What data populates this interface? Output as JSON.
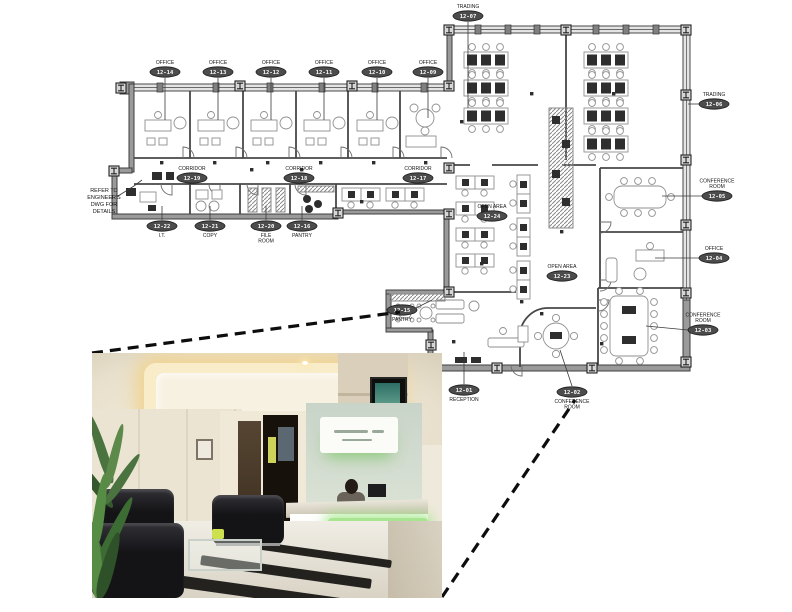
{
  "meta": {
    "title": "Office floor plan with reception lobby photo callout"
  },
  "plan": {
    "note_lines": [
      "REFER TO",
      "ENGINEER'S",
      "DWG FOR",
      "DETAILS"
    ],
    "labels": [
      {
        "id": "office-12-14",
        "name_lines": [
          "OFFICE"
        ],
        "number": "12-14",
        "x": 165,
        "y": 72,
        "name_pos": "above",
        "leader": [
          165,
          78,
          165,
          120
        ]
      },
      {
        "id": "office-12-13",
        "name_lines": [
          "OFFICE"
        ],
        "number": "12-13",
        "x": 218,
        "y": 72,
        "name_pos": "above",
        "leader": [
          218,
          78,
          218,
          120
        ]
      },
      {
        "id": "office-12-12",
        "name_lines": [
          "OFFICE"
        ],
        "number": "12-12",
        "x": 271,
        "y": 72,
        "name_pos": "above",
        "leader": [
          271,
          78,
          271,
          120
        ]
      },
      {
        "id": "office-12-11",
        "name_lines": [
          "OFFICE"
        ],
        "number": "12-11",
        "x": 324,
        "y": 72,
        "name_pos": "above",
        "leader": [
          324,
          78,
          324,
          120
        ]
      },
      {
        "id": "office-12-10",
        "name_lines": [
          "OFFICE"
        ],
        "number": "12-10",
        "x": 377,
        "y": 72,
        "name_pos": "above",
        "leader": [
          377,
          78,
          377,
          120
        ]
      },
      {
        "id": "office-12-09",
        "name_lines": [
          "OFFICE"
        ],
        "number": "12-09",
        "x": 428,
        "y": 72,
        "name_pos": "above",
        "leader": [
          428,
          78,
          428,
          118
        ]
      },
      {
        "id": "trading-12-07",
        "name_lines": [
          "TRADING"
        ],
        "number": "12-07",
        "x": 468,
        "y": 16,
        "name_pos": "above",
        "leader": [
          468,
          22,
          468,
          108
        ]
      },
      {
        "id": "trading-12-06",
        "name_lines": [
          "TRADING"
        ],
        "number": "12-06",
        "x": 714,
        "y": 104,
        "name_pos": "above",
        "leader": [
          699,
          104,
          688,
          104
        ]
      },
      {
        "id": "conference-room-12-05",
        "name_lines": [
          "CONFERENCE",
          "ROOM"
        ],
        "number": "12-05",
        "x": 717,
        "y": 196,
        "name_pos": "above",
        "leader": [
          702,
          196,
          662,
          196
        ]
      },
      {
        "id": "office-12-04",
        "name_lines": [
          "OFFICE"
        ],
        "number": "12-04",
        "x": 714,
        "y": 258,
        "name_pos": "above",
        "leader": [
          699,
          258,
          655,
          258
        ]
      },
      {
        "id": "conference-room-12-03",
        "name_lines": [
          "CONFERENCE",
          "ROOM"
        ],
        "number": "12-03",
        "x": 703,
        "y": 330,
        "name_pos": "above",
        "leader": [
          688,
          330,
          646,
          326
        ]
      },
      {
        "id": "conference-room-12-02",
        "name_lines": [
          "CONFERENCE",
          "ROOM"
        ],
        "number": "12-02",
        "x": 572,
        "y": 392,
        "name_pos": "below",
        "leader": [
          572,
          386,
          560,
          350
        ]
      },
      {
        "id": "reception-12-01",
        "name_lines": [
          "RECEPTION"
        ],
        "number": "12-01",
        "x": 464,
        "y": 390,
        "name_pos": "below",
        "leader": [
          464,
          384,
          464,
          352
        ]
      },
      {
        "id": "pantry-12-15",
        "name_lines": [
          "PANTRY"
        ],
        "number": "12-15",
        "x": 402,
        "y": 310,
        "name_pos": "below",
        "leader": [
          416,
          308,
          432,
          300
        ]
      },
      {
        "id": "open-area-12-24",
        "name_lines": [
          "OPEN AREA"
        ],
        "number": "12-24",
        "x": 492,
        "y": 216,
        "name_pos": "above"
      },
      {
        "id": "open-area-12-23",
        "name_lines": [
          "OPEN AREA"
        ],
        "number": "12-23",
        "x": 562,
        "y": 276,
        "name_pos": "above"
      },
      {
        "id": "corridor-12-19",
        "name_lines": [
          "CORRIDOR"
        ],
        "number": "12-19",
        "x": 192,
        "y": 178,
        "name_pos": "above"
      },
      {
        "id": "corridor-12-18",
        "name_lines": [
          "CORRIDOR"
        ],
        "number": "12-18",
        "x": 299,
        "y": 178,
        "name_pos": "above"
      },
      {
        "id": "corridor-12-17",
        "name_lines": [
          "CORRIDOR"
        ],
        "number": "12-17",
        "x": 418,
        "y": 178,
        "name_pos": "above"
      },
      {
        "id": "it-12-22",
        "name_lines": [
          "I.T."
        ],
        "number": "12-22",
        "x": 162,
        "y": 226,
        "name_pos": "below",
        "leader": [
          162,
          220,
          162,
          206
        ]
      },
      {
        "id": "copy-12-21",
        "name_lines": [
          "COPY"
        ],
        "number": "12-21",
        "x": 210,
        "y": 226,
        "name_pos": "below",
        "leader": [
          210,
          220,
          210,
          206
        ]
      },
      {
        "id": "file-room-12-20",
        "name_lines": [
          "FILE",
          "ROOM"
        ],
        "number": "12-20",
        "x": 266,
        "y": 226,
        "name_pos": "below",
        "leader": [
          266,
          220,
          266,
          206
        ]
      },
      {
        "id": "pantry-12-16",
        "name_lines": [
          "PANTRY"
        ],
        "number": "12-16",
        "x": 302,
        "y": 226,
        "name_pos": "below",
        "leader": [
          302,
          220,
          302,
          206
        ]
      }
    ],
    "colors": {
      "wall_gray": "#9a9a9a",
      "label_fill": "#4c4c4c",
      "label_text": "#ffffff",
      "callout_dash": "#0d0d0d"
    }
  },
  "photo": {
    "subject": "reception-lobby",
    "accent_green": "#a9e490",
    "sign_wall_green": "#cfdacf",
    "wall_beige": "#d9cfba"
  }
}
